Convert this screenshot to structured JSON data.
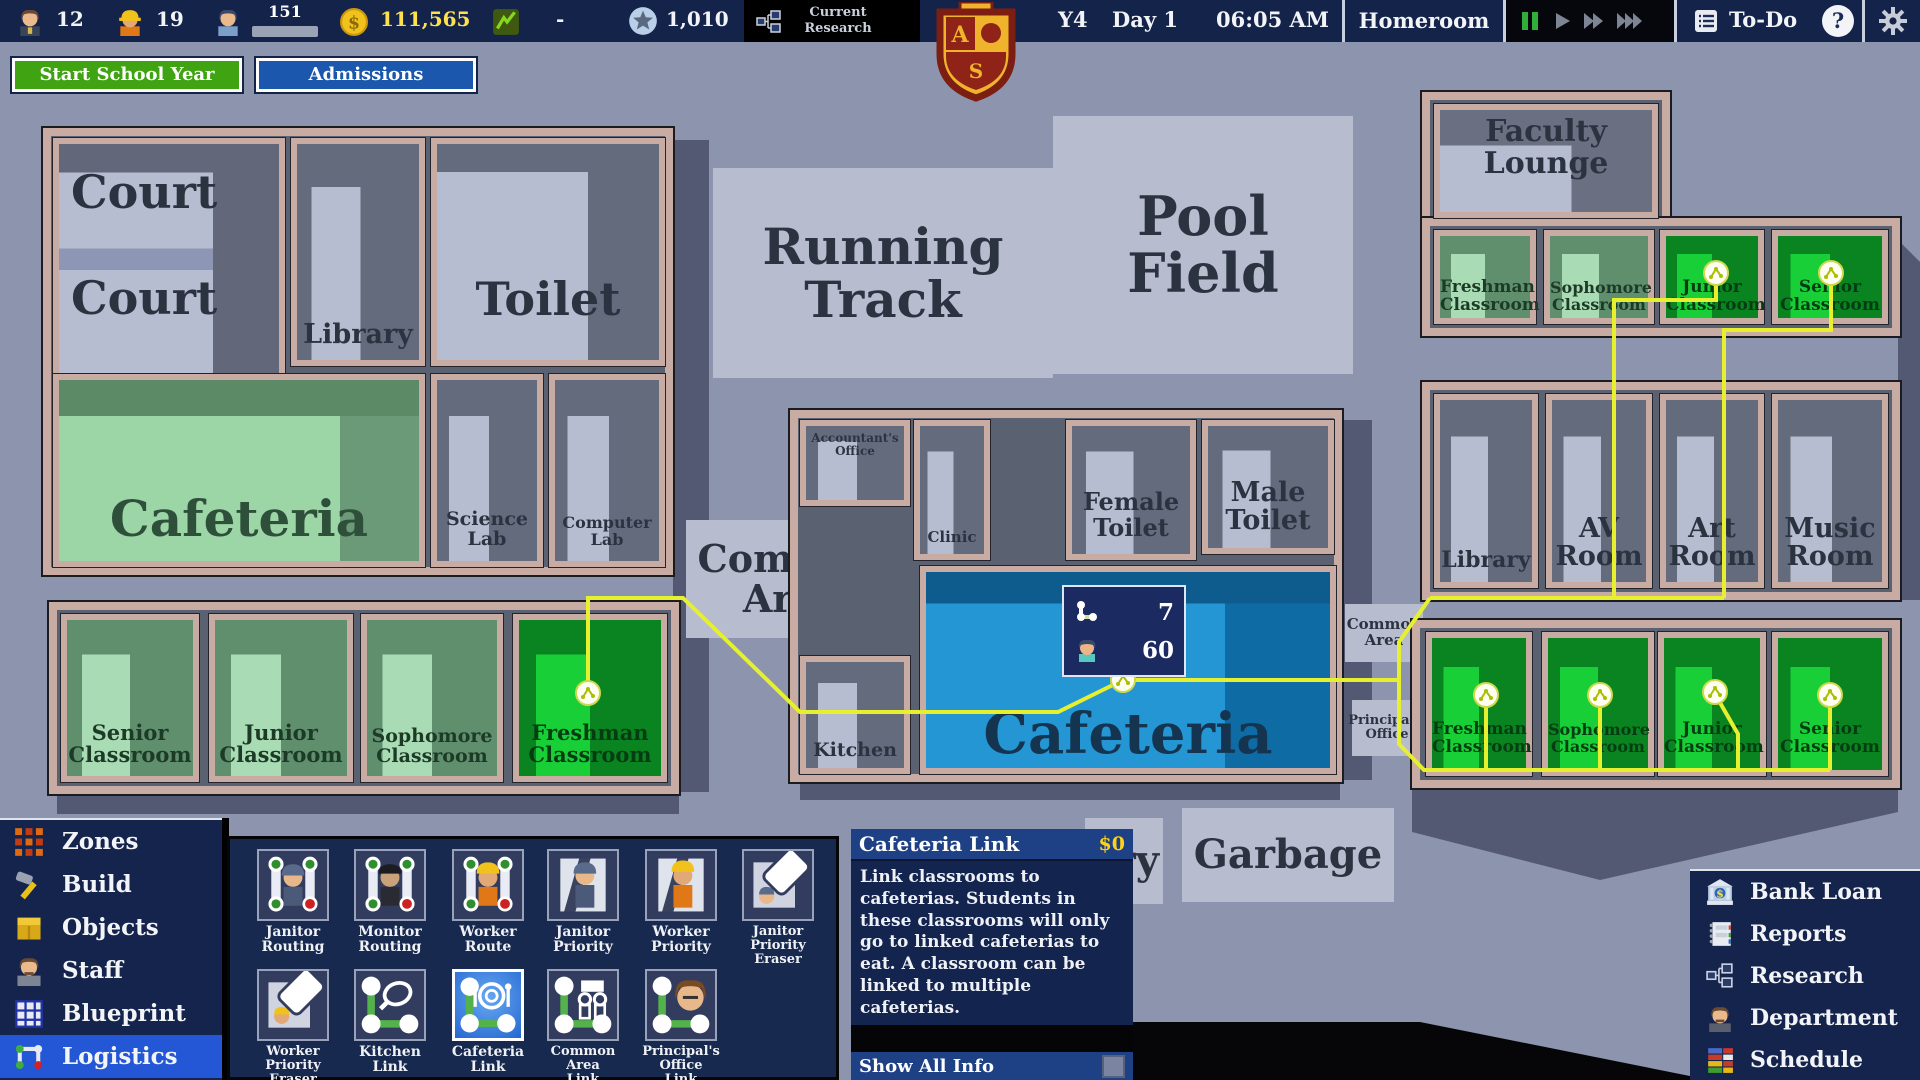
{
  "topbar": {
    "teachers": "12",
    "workers": "19",
    "students": "151",
    "money": "111,565",
    "trend": "-",
    "prestige": "1,010",
    "research_label": "Current Research",
    "year": "Y4",
    "day": "Day 1",
    "time": "06:05 AM",
    "period": "Homeroom",
    "todo": "To-Do",
    "help": "?"
  },
  "actions": {
    "start_school_year": "Start School Year",
    "admissions": "Admissions"
  },
  "map": {
    "popup": {
      "links": "7",
      "students": "60"
    },
    "rooms": {
      "court_a": "Court",
      "court_b": "Court",
      "library_w": "Library",
      "toilet_w": "Toilet",
      "cafeteria_w": "Cafeteria",
      "science_lab": "Science\nLab",
      "computer_lab": "Computer\nLab",
      "senior_w": "Senior\nClassroom",
      "junior_w": "Junior\nClassroom",
      "sophomore_w": "Sophomore\nClassroom",
      "freshman_w": "Freshman\nClassroom",
      "running_track": "Running\nTrack",
      "pool_field": "Pool\nField",
      "accountants_office": "Accountant's\nOffice",
      "clinic": "Clinic",
      "common_area_c": "Common\nArea",
      "kitchen": "Kitchen",
      "female_toilet": "Female\nToilet",
      "male_toilet": "Male\nToilet",
      "cafeteria_c": "Cafeteria",
      "common_area_r": "Common\nArea",
      "principals_office": "Principal's\nOffice",
      "faculty_lounge": "Faculty\nLounge",
      "freshman_tr": "Freshman\nClassroom",
      "sophomore_tr": "Sophomore\nClassroom",
      "junior_tr": "Junior\nClassroom",
      "senior_tr": "Senior\nClassroom",
      "library_r": "Library",
      "av_room": "AV\nRoom",
      "art_room": "Art\nRoom",
      "music_room": "Music\nRoom",
      "freshman_br": "Freshman\nClassroom",
      "sophomore_br": "Sophomore\nClassroom",
      "junior_br": "Junior\nClassroom",
      "senior_br": "Senior\nClassroom",
      "garbage": "Garbage",
      "partial_zone": "ry"
    }
  },
  "menus": {
    "left": [
      {
        "label": "Zones"
      },
      {
        "label": "Build"
      },
      {
        "label": "Objects"
      },
      {
        "label": "Staff"
      },
      {
        "label": "Blueprint"
      },
      {
        "label": "Logistics",
        "selected": true
      }
    ],
    "toolbar": [
      {
        "label": "Janitor\nRouting"
      },
      {
        "label": "Monitor\nRouting"
      },
      {
        "label": "Worker\nRoute"
      },
      {
        "label": "Janitor\nPriority"
      },
      {
        "label": "Worker\nPriority"
      },
      {
        "label": "Janitor\nPriority\nEraser"
      },
      {
        "label": "Worker\nPriority\nEraser"
      },
      {
        "label": "Kitchen\nLink"
      },
      {
        "label": "Cafeteria\nLink",
        "selected": true
      },
      {
        "label": "Common\nArea\nLink"
      },
      {
        "label": "Principal's\nOffice\nLink"
      }
    ],
    "right": [
      {
        "label": "Bank Loan"
      },
      {
        "label": "Reports"
      },
      {
        "label": "Research"
      },
      {
        "label": "Department"
      },
      {
        "label": "Schedule"
      }
    ]
  },
  "tooltip": {
    "title": "Cafeteria Link",
    "cost": "$0",
    "body": "Link classrooms to cafeterias. Students in these classrooms will only go to linked cafeterias to eat. A classroom can be linked to multiple cafeterias.",
    "footer": "Show All Info"
  },
  "colors": {
    "money_yellow": "#ffe14d",
    "link_yellow": "#e6f02e",
    "selected_blue": "#2457d6",
    "start_button_green": "#3fa312",
    "admissions_blue": "#1b57ad"
  }
}
